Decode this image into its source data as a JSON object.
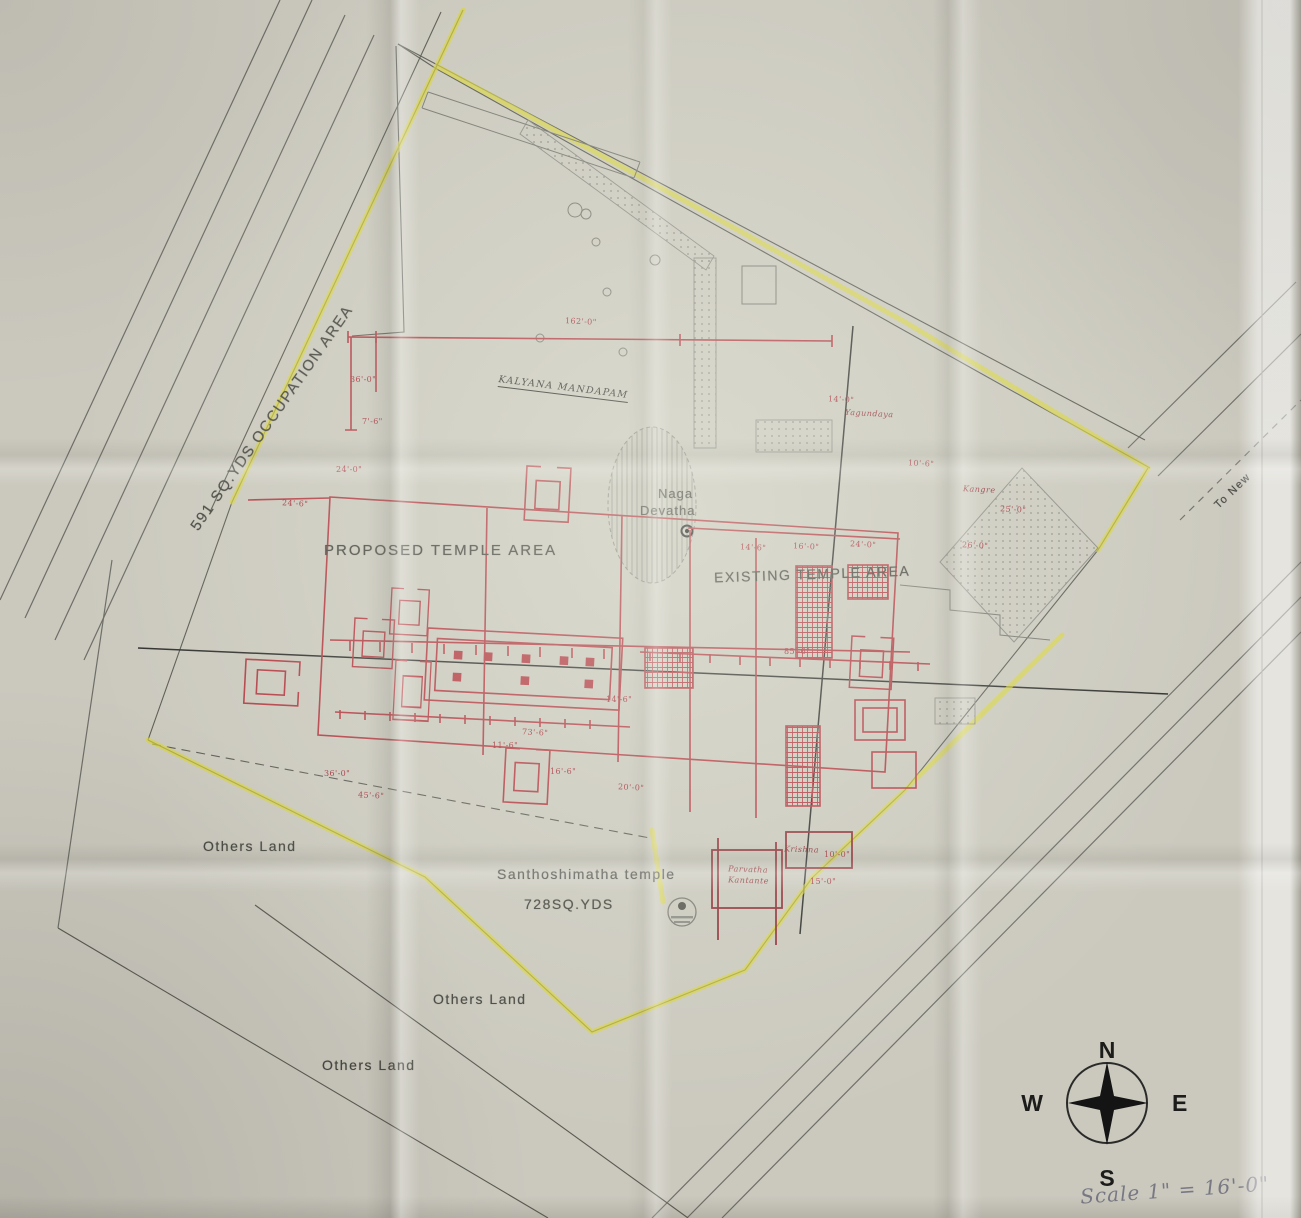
{
  "labels": {
    "occupation_area": "591 SQ.YDS OCCUPATION AREA",
    "proposed_temple_area": "PROPOSED TEMPLE AREA",
    "existing_temple_area": "EXISTING TEMPLE AREA",
    "naga": "Naga",
    "devatha": "Devatha",
    "kalyana_mandapam": "KALYANA MANDAPAM",
    "temple_name": "Santhoshimatha temple",
    "temple_area_value": "728SQ.YDS",
    "others_land": "Others Land",
    "to_new": "To New",
    "scale_note": "Scale 1\" = 16'-0\""
  },
  "compass": {
    "n": "N",
    "e": "E",
    "s": "S",
    "w": "W"
  },
  "annotations": [
    {
      "text": "Yagundaya"
    },
    {
      "text": "Kangre"
    },
    {
      "text": "Parvatha"
    },
    {
      "text": "Kantante"
    },
    {
      "text": "Krishna"
    }
  ],
  "dimensions": [
    "162'-0\"",
    "36'-0\"",
    "7'-6\"",
    "24'-0\"",
    "24'-6\"",
    "14'-0\"",
    "10'-6\"",
    "25'-0\"",
    "26'-0\"",
    "14'-6\"",
    "16'-0\"",
    "24'-0\"",
    "85'-6\"",
    "73'-6\"",
    "45'-6\"",
    "14'-6\"",
    "11'-6\"",
    "20'-0\"",
    "36'-0\"",
    "16'-6\"",
    "10'-0\"",
    "15'-0\""
  ],
  "colors": {
    "paper": "#cbc9be",
    "highlighter": "#d9d437",
    "plan_red": "#b23a42",
    "line_gray": "#6e6e68"
  }
}
